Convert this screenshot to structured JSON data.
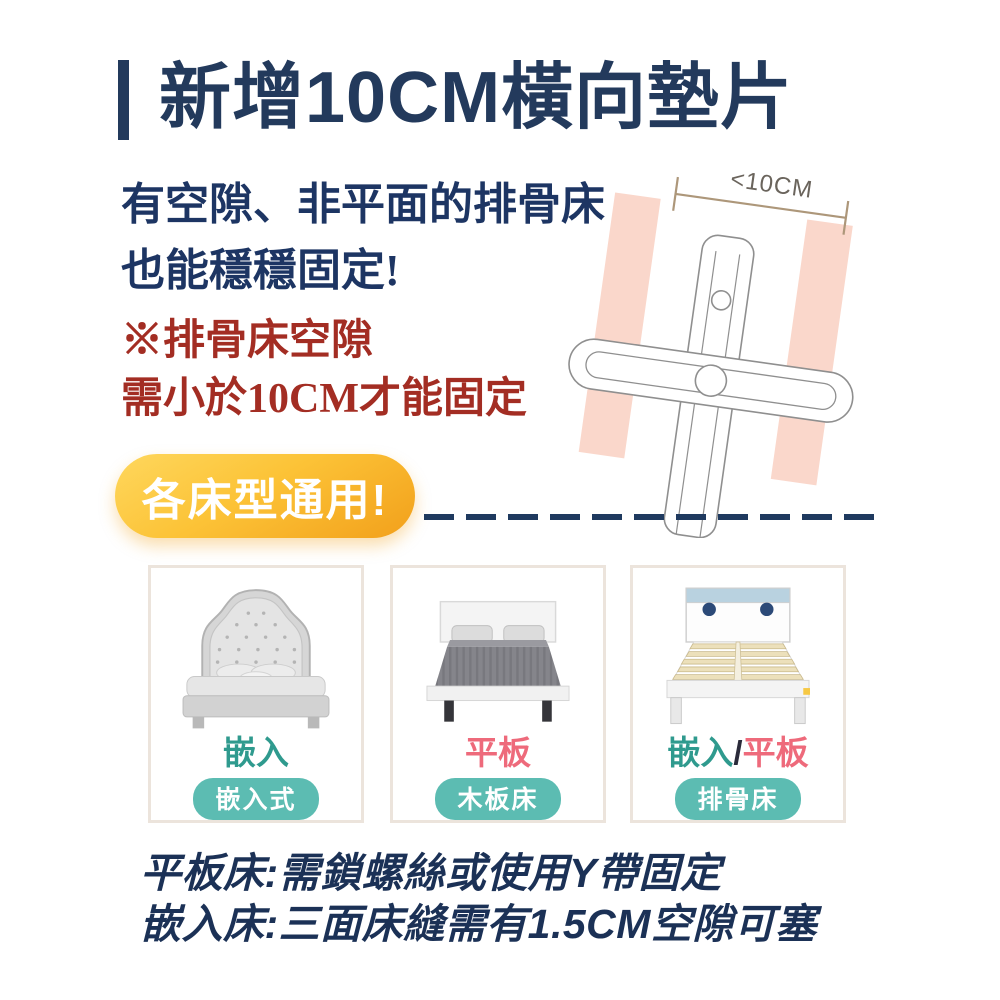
{
  "title": {
    "text": "新增10CM橫向墊片"
  },
  "intro": {
    "line1": "有空隙、非平面的排骨床",
    "line2": "也能穩穩固定!"
  },
  "note": {
    "line1": "※排骨床空隙",
    "line2": "需小於10CM才能固定"
  },
  "diagram": {
    "gap_label": "<10CM"
  },
  "badge": {
    "label": "各床型通用!"
  },
  "cards": {
    "embed": {
      "label": "嵌入",
      "badge": "嵌入式"
    },
    "flat": {
      "label": "平板",
      "badge": "木板床"
    },
    "slat": {
      "label_a": "嵌入",
      "label_sep": "/",
      "label_b": "平板",
      "badge": "排骨床"
    }
  },
  "footnotes": {
    "line1": "平板床:需鎖螺絲或使用Y帶固定",
    "line2": "嵌入床:三面床縫需有1.5CM空隙可塞"
  },
  "colors": {
    "navy": "#233a5c",
    "dark_red": "#a32d23",
    "salmon_slat": "#fad7cb",
    "badge_gold": "#fcc337",
    "teal_label": "#2f9a8e",
    "teal_pill": "#5cbcb2",
    "pink_label": "#ee6a7b",
    "diagram_outline": "#8f8f8f",
    "bracket_tan": "#ad977a"
  }
}
